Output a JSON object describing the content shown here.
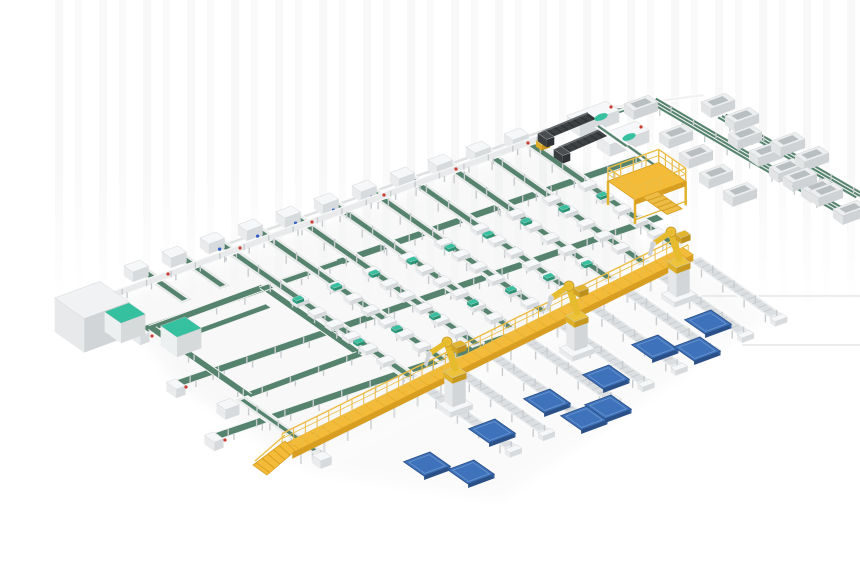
{
  "meta": {
    "description": "Isometric 3D render of an automated parcel sortation and robotic palletizing system: green belt sorter lanes with induction stations, telescopic truck loaders, yellow maintenance platform and elevated walkway with stairs, discharge roller lanes, three yellow palletizing robots and blue floor pallets"
  },
  "canvas": {
    "w": 860,
    "h": 580
  },
  "palette": {
    "belt_green": "#55836d",
    "belt_green_dark": "#3f6a57",
    "teal": "#35c0a0",
    "frame": "#e9ebeb",
    "frame_edge": "#f9fafa",
    "frame_inner": "#d9dcde",
    "leg": "#c9cccf",
    "deck_yellow": "#f3bb37",
    "deck_front": "#d89e22",
    "rail_yellow": "#ecbc45",
    "robot_yellow": "#e7bb2e",
    "robot_dark": "#c2951f",
    "pallet_top": "#3e72ba",
    "pallet_side": "#2b5087",
    "pallet_side2": "#33639f",
    "pallet_inner": "#6b95cf",
    "loader_dark": "#3d4043",
    "loader_top": "#63676a",
    "loader_rib": "#2c2f31",
    "red_dot": "#cc3b2f",
    "blue_dot": "#2f5fc0",
    "floor_line": "#e2e2e2",
    "shadow": "#8a8f92"
  },
  "axes": {
    "u": [
      0.938,
      -0.345
    ],
    "v": [
      0.82,
      0.574
    ]
  },
  "floor_lines": [
    [
      [
        700,
        296
      ],
      [
        860,
        296
      ]
    ],
    [
      [
        742,
        345
      ],
      [
        860,
        345
      ]
    ]
  ],
  "induct_line": {
    "from": [
      110,
      296
    ],
    "to": [
      560,
      131
    ],
    "w": 8,
    "support_rail": {
      "from": [
        205,
        252
      ],
      "to": [
        548,
        129
      ]
    }
  },
  "stations": {
    "first": [
      218,
      242
    ],
    "step": [
      38,
      -13
    ],
    "count": 9,
    "extra": [
      [
        180,
        256
      ],
      [
        142,
        270
      ]
    ],
    "extra_lane_len": 55
  },
  "lanes": {
    "end_line": [
      [
        287,
        448
      ],
      [
        688,
        250
      ]
    ],
    "margin": 8,
    "bed_w": 13,
    "belt_w": 5.5,
    "tote_start_frac": 0.42,
    "tote_step": 21,
    "leg_step": 27,
    "cap_ts": [
      98,
      172
    ]
  },
  "cross_belts": [
    {
      "from": [
        140,
        331
      ],
      "to": [
        640,
        158
      ]
    },
    {
      "from": [
        176,
        384
      ],
      "to": [
        660,
        217
      ]
    },
    {
      "from": [
        214,
        437
      ],
      "to": [
        527,
        330
      ]
    }
  ],
  "loop": {
    "c1": [
      152,
      328
    ],
    "lu": 119,
    "lv": 117,
    "w": 8,
    "inner": {
      "from": [
        180,
        338
      ],
      "to": [
        268,
        306
      ]
    },
    "connector": {
      "from": [
        262,
        289
      ],
      "to": [
        340,
        262
      ]
    },
    "tail": {
      "from": [
        240,
        398
      ],
      "len": 95,
      "end_box": [
        322,
        456
      ]
    }
  },
  "boxes": [
    {
      "c": [
        92,
        300
      ],
      "lu": 48,
      "lv": 36,
      "h": 34,
      "role": "cabinet"
    },
    {
      "c": [
        125,
        313
      ],
      "lu": 26,
      "lv": 20,
      "h": 20,
      "role": "teal"
    },
    {
      "c": [
        181,
        327
      ],
      "lu": 26,
      "lv": 20,
      "h": 20,
      "role": "teal"
    },
    {
      "c": [
        228,
        404
      ],
      "lu": 15,
      "lv": 11,
      "h": 10,
      "role": "white"
    },
    {
      "c": [
        543,
        141
      ],
      "lu": 9,
      "lv": 7,
      "h": 6,
      "role": "yellow"
    }
  ],
  "loaders": [
    {
      "boom_from": [
        546,
        135
      ],
      "boom_to": [
        592,
        116
      ],
      "mach": [
        593,
        113
      ],
      "oval": [
        601,
        117
      ],
      "dot": [
        611,
        107
      ]
    },
    {
      "boom_from": [
        562,
        151
      ],
      "boom_to": [
        608,
        131
      ],
      "mach": [
        623,
        133
      ],
      "oval": [
        629,
        137
      ],
      "dot": [
        641,
        127
      ]
    }
  ],
  "loader_belts": [
    {
      "from": [
        598,
        126
      ],
      "to": [
        652,
        164
      ]
    },
    {
      "from": [
        628,
        146
      ],
      "to": [
        678,
        182
      ]
    }
  ],
  "topright": {
    "link": {
      "from": [
        560,
        130
      ],
      "to": [
        650,
        100
      ]
    },
    "white_line": {
      "from": [
        612,
        107
      ],
      "to": [
        704,
        95
      ]
    }
  },
  "spurs": [
    {
      "from": [
        652,
        100
      ],
      "to": [
        850,
        216
      ]
    },
    {
      "from": [
        722,
        116
      ],
      "to": [
        860,
        196
      ]
    }
  ],
  "bins": [
    [
      745,
      133
    ],
    [
      766,
      150
    ],
    [
      786,
      166
    ],
    [
      818,
      186
    ],
    [
      676,
      132
    ],
    [
      696,
      152
    ],
    [
      716,
      172
    ],
    [
      740,
      190
    ],
    [
      788,
      140
    ],
    [
      812,
      154
    ],
    [
      800,
      175
    ],
    [
      826,
      190
    ],
    [
      850,
      208
    ],
    [
      641,
      103
    ],
    [
      718,
      101
    ],
    [
      742,
      115
    ]
  ],
  "platform": {
    "origin": [
      608,
      181
    ],
    "lu": 54,
    "lv": 33,
    "leg_h": 24,
    "rail_h": 13
  },
  "walkway": {
    "from": [
      287,
      449
    ],
    "to": [
      688,
      251
    ],
    "deck_w": 13,
    "rail_h": 12,
    "leg_h": 18
  },
  "discharge": {
    "gap": 20,
    "len": 100,
    "w": 14
  },
  "robots": [
    [
      455,
      408
    ],
    [
      577,
      352
    ],
    [
      679,
      298
    ]
  ],
  "pallets": [
    [
      492,
      431
    ],
    [
      427,
      464
    ],
    [
      471,
      472
    ],
    [
      547,
      401
    ],
    [
      584,
      418
    ],
    [
      608,
      407
    ],
    [
      606,
      377
    ],
    [
      655,
      347
    ],
    [
      697,
      349
    ],
    [
      708,
      322
    ]
  ],
  "dots": {
    "red": [
      [
        168,
        274
      ],
      [
        240,
        248
      ],
      [
        312,
        222
      ],
      [
        384,
        195
      ],
      [
        456,
        169
      ],
      [
        528,
        143
      ],
      [
        152,
        336
      ],
      [
        186,
        387
      ],
      [
        225,
        440
      ]
    ]
  }
}
